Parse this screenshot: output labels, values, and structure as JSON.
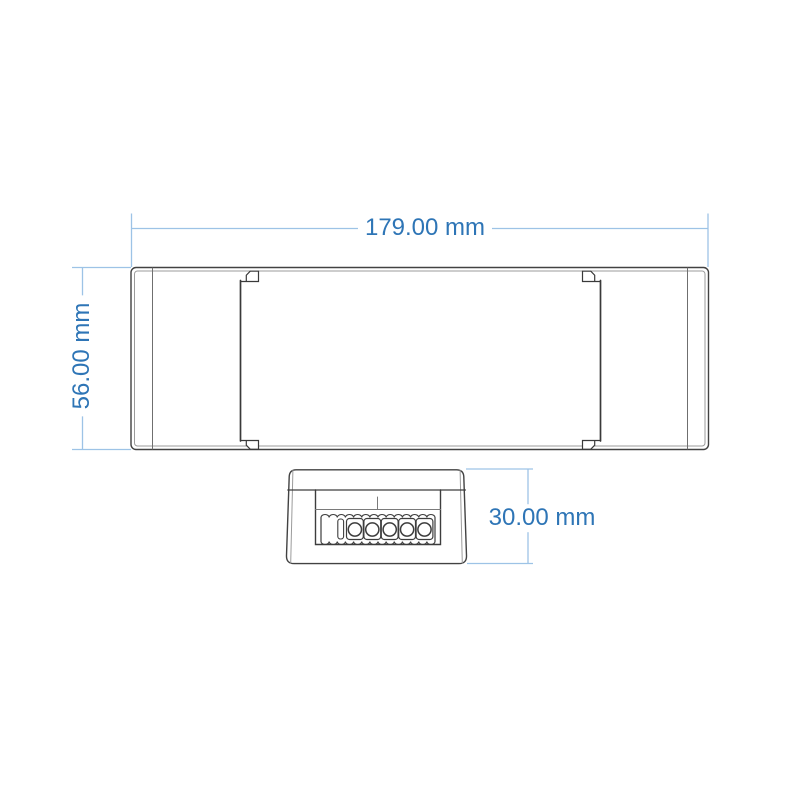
{
  "drawing": {
    "type": "technical-dimension-drawing",
    "views": {
      "top_view": {
        "name": "enclosure top view"
      },
      "front_view": {
        "name": "enclosure end view",
        "terminal_count": 5
      }
    }
  },
  "dimensions": {
    "width": {
      "label": "179.00 mm",
      "value": "179.00",
      "unit": "mm"
    },
    "height": {
      "label": "56.00 mm",
      "value": "56.00",
      "unit": "mm"
    },
    "depth": {
      "label": "30.00 mm",
      "value": "30.00",
      "unit": "mm"
    }
  },
  "colors": {
    "dimension_line": "#9dc3e6",
    "dimension_text": "#2e75b6",
    "outline_dark": "#3f3f3f",
    "outline_light": "#9b9b9b",
    "background": "#ffffff"
  }
}
